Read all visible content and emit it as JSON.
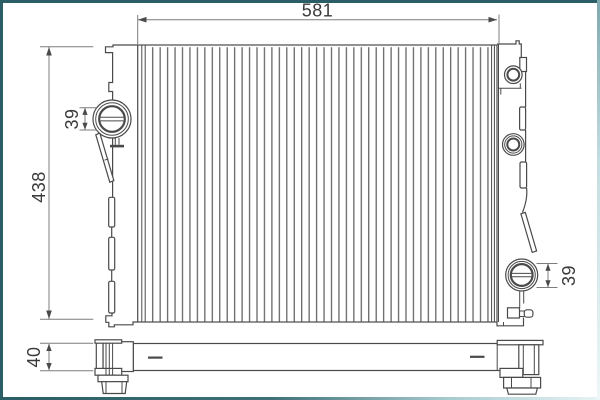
{
  "drawing": {
    "description": "radiator-technical-drawing",
    "dimension_labels": {
      "top_width": "581",
      "left_height": "438",
      "left_port": "39",
      "right_port": "39",
      "bottom_depth": "40"
    },
    "colors": {
      "frame_border": "#2a5d65",
      "line_art": "#4a4a4a",
      "fins": "#5a5a5a",
      "dimension_lines": "#7d7d7d",
      "label_text": "#3a3a3a",
      "background": "#ffffff"
    }
  }
}
